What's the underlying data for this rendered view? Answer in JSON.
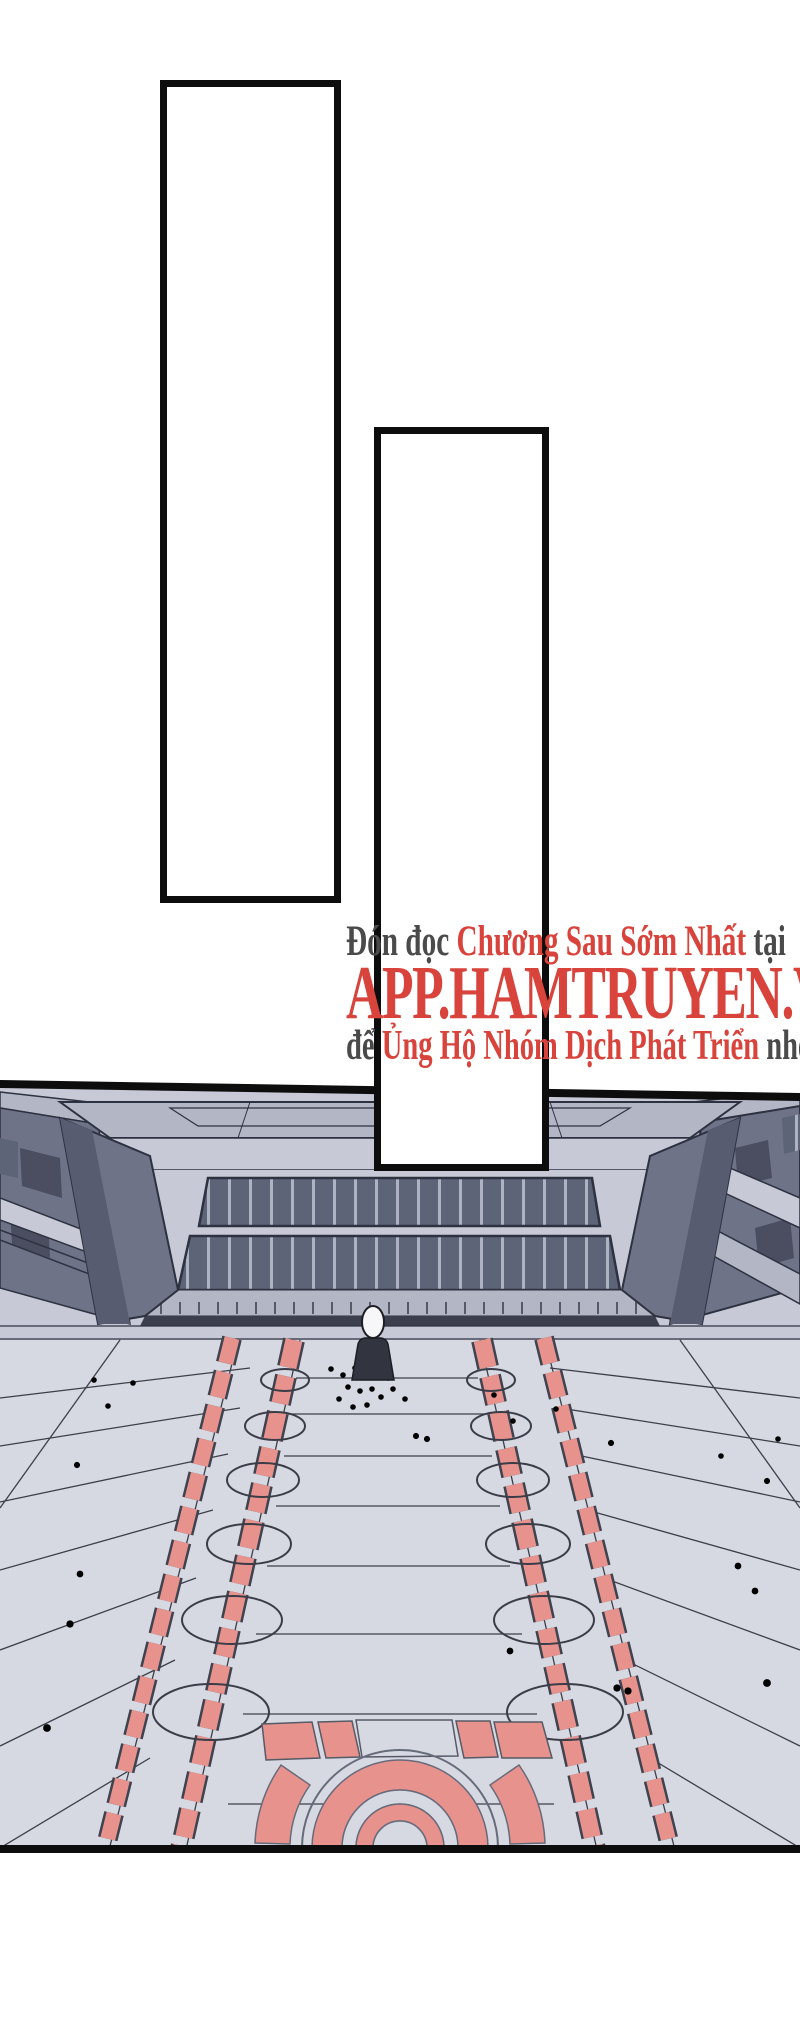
{
  "page": {
    "background": "#ffffff"
  },
  "speech_bubbles": [
    {
      "id": "tall-left",
      "text": ""
    },
    {
      "id": "tall-right",
      "text": ""
    }
  ],
  "promo": {
    "line1_prefix": "Đón đọc",
    "line1_highlight": "Chương Sau Sớm Nhất",
    "line1_suffix": "tại",
    "url": "APP.HAMTRUYEN.VN",
    "line3_prefix": "để",
    "line3_highlight": "Ủng Hộ Nhóm Dịch Phát Triển",
    "line3_suffix": "nhé"
  },
  "colors": {
    "promo_red": "#d8433c",
    "promo_gray": "#4a4a4a",
    "panel_border": "#0d0d0d",
    "ink": "#2e3140",
    "plaza": "#d7d9e2",
    "facade_light": "#c7cad6",
    "facade_mid": "#b2b6c5",
    "wall_dark": "#6e7388",
    "wall_darker": "#585c70",
    "window_dark": "#5e6478",
    "window_mullion": "#aeb3c2",
    "accent_red": "#e8928d",
    "figure_dark": "#32343f"
  },
  "scene": {
    "subject": "plaza-in-front-of-building",
    "figure": "speaker-at-podium",
    "crowd_marks": 37,
    "floor_circles_per_side": 6,
    "dais": "concentric-semicircle"
  }
}
